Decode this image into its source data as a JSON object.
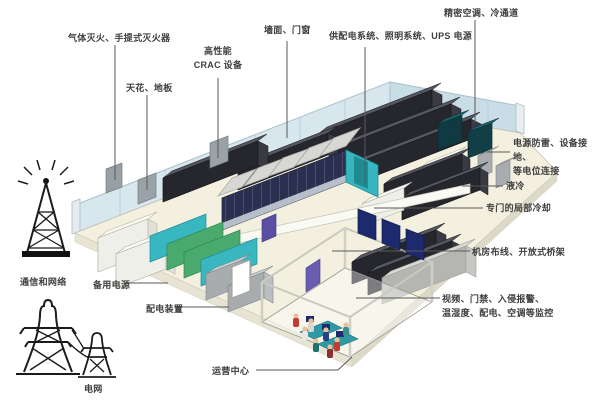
{
  "diagram_type": "data-center-room-composition",
  "colors": {
    "background": "#ffffff",
    "floor": "#f3f0e0",
    "wall_left": "#d8e7ee",
    "wall_right": "#c9dde7",
    "rack_dark": "#26262d",
    "pod_front": "#2b3050",
    "pod_roof": "#d7d7d4",
    "teal_accent": "#38b6c0",
    "teal_dark_unit": "#123f47",
    "generator_green": "#4aa96c",
    "screen_blue": "#1d2a6e",
    "door_purple": "#5b4fa3",
    "gray_equipment": "#a8acaf",
    "white_cabinet": "#efefe9",
    "leader_line": "#5a5a5a",
    "label_text": "#3e3e3e",
    "icon_ink": "#1b1b1b"
  },
  "labels": [
    {
      "id": "fire-suppression",
      "text": "气体灭火、手提式灭火器"
    },
    {
      "id": "ceiling-floor",
      "text": "天花、地板"
    },
    {
      "id": "crac-equipment",
      "text": "高性能\nCRAC 设备"
    },
    {
      "id": "wall-doors-windows",
      "text": "墙面、门窗"
    },
    {
      "id": "power-lighting-ups",
      "text": "供配电系统、照明系统、UPS 电源"
    },
    {
      "id": "precision-ac",
      "text": "精密空调、冷通道"
    },
    {
      "id": "surge-grounding",
      "text": "电源防雷、设备接地、\n等电位连接"
    },
    {
      "id": "liquid-cooling",
      "text": "液冷"
    },
    {
      "id": "local-cooling",
      "text": "专门的局部冷却"
    },
    {
      "id": "cabling-tray",
      "text": "机房布线、开放式桥架"
    },
    {
      "id": "monitoring",
      "text": "视频、门禁、入侵报警、\n温湿度、配电、空调等监控"
    },
    {
      "id": "comm-network",
      "text": "通信和网络"
    },
    {
      "id": "backup-power",
      "text": "备用电源"
    },
    {
      "id": "distribution-gear",
      "text": "配电装置"
    },
    {
      "id": "operations-center",
      "text": "运营中心"
    },
    {
      "id": "power-grid",
      "text": "电网"
    }
  ],
  "icons": [
    {
      "id": "transmission-tower-icon",
      "meaning": "通信和网络"
    },
    {
      "id": "power-pylons-icon",
      "meaning": "电网"
    }
  ]
}
